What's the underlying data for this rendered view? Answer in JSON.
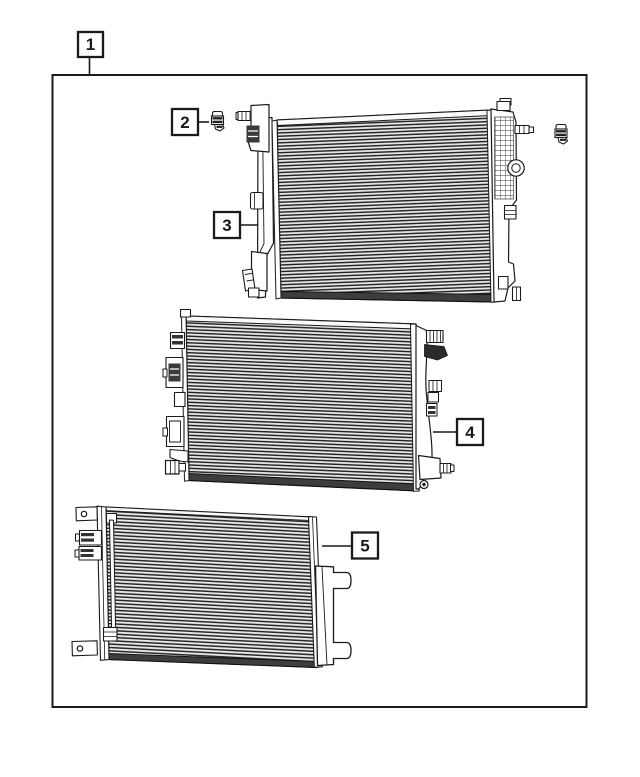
{
  "figure": {
    "type": "parts-diagram",
    "colors": {
      "background": "#ffffff",
      "line": "#1a1a1a",
      "fin_light": "#e9e9e9",
      "fin_dark": "#262626",
      "band_dark": "#3d3d3d",
      "clip_dark": "#222222"
    },
    "callouts": [
      {
        "label": "1",
        "points_to": "assembly-boundary"
      },
      {
        "label": "2",
        "points_to": "retainer-clip"
      },
      {
        "label": "3",
        "points_to": "radiator-upper"
      },
      {
        "label": "4",
        "points_to": "radiator-lower"
      },
      {
        "label": "5",
        "points_to": "condenser"
      }
    ]
  }
}
